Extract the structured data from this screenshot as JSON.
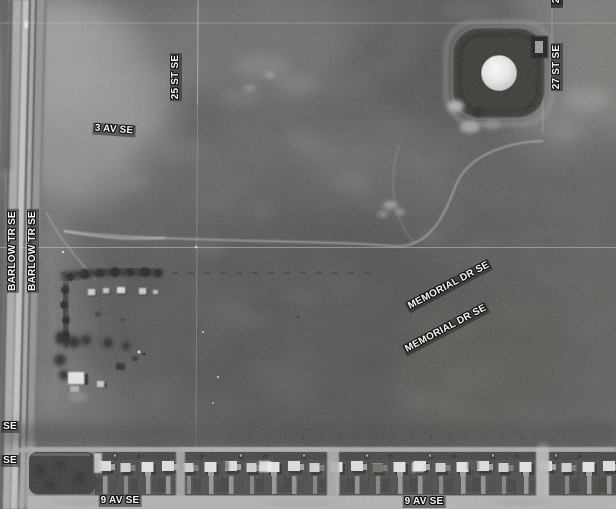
{
  "map": {
    "type": "aerial-imagery-with-street-overlay",
    "colors": {
      "label_text": "#f5f5f3",
      "label_halo": "#141412",
      "label_backdrop": "rgba(32,32,30,0.5)",
      "field_base": "#555553",
      "road_light": "#c6c6c4",
      "tank_white": "#efefed"
    },
    "labels": [
      {
        "name": "street-label-barlow-tr-se-1",
        "text": "BARLOW TR SE",
        "x": 13,
        "y": 251,
        "rotation": -90
      },
      {
        "name": "street-label-barlow-tr-se-2",
        "text": "BARLOW TR SE",
        "x": 33,
        "y": 251,
        "rotation": -90
      },
      {
        "name": "street-label-25-st-se",
        "text": "25 ST SE",
        "x": 176,
        "y": 77,
        "rotation": -90
      },
      {
        "name": "street-label-3-av-se",
        "text": "3 AV SE",
        "x": 114,
        "y": 130,
        "rotation": 4
      },
      {
        "name": "street-label-27-st-se",
        "text": "27 ST SE",
        "x": 557,
        "y": 67,
        "rotation": -90
      },
      {
        "name": "street-label-27-st-se-partial",
        "text": "27 ST SE",
        "x": 557,
        "y": -19,
        "rotation": -90
      },
      {
        "name": "street-label-memorial-dr-se-1",
        "text": "MEMORIAL DR SE",
        "x": 449,
        "y": 286,
        "rotation": -28
      },
      {
        "name": "street-label-memorial-dr-se-2",
        "text": "MEMORIAL DR SE",
        "x": 446,
        "y": 329,
        "rotation": -28
      },
      {
        "name": "street-label-9-av-se-1",
        "text": "9 AV SE",
        "x": 120,
        "y": 501,
        "rotation": 0
      },
      {
        "name": "street-label-9-av-se-2",
        "text": "9 AV SE",
        "x": 424,
        "y": 502,
        "rotation": 0
      },
      {
        "name": "street-label-partial-se-1",
        "text": "SE",
        "x": 10,
        "y": 427,
        "rotation": 0
      },
      {
        "name": "street-label-partial-se-2",
        "text": "SE",
        "x": 10,
        "y": 461,
        "rotation": 0
      }
    ]
  }
}
